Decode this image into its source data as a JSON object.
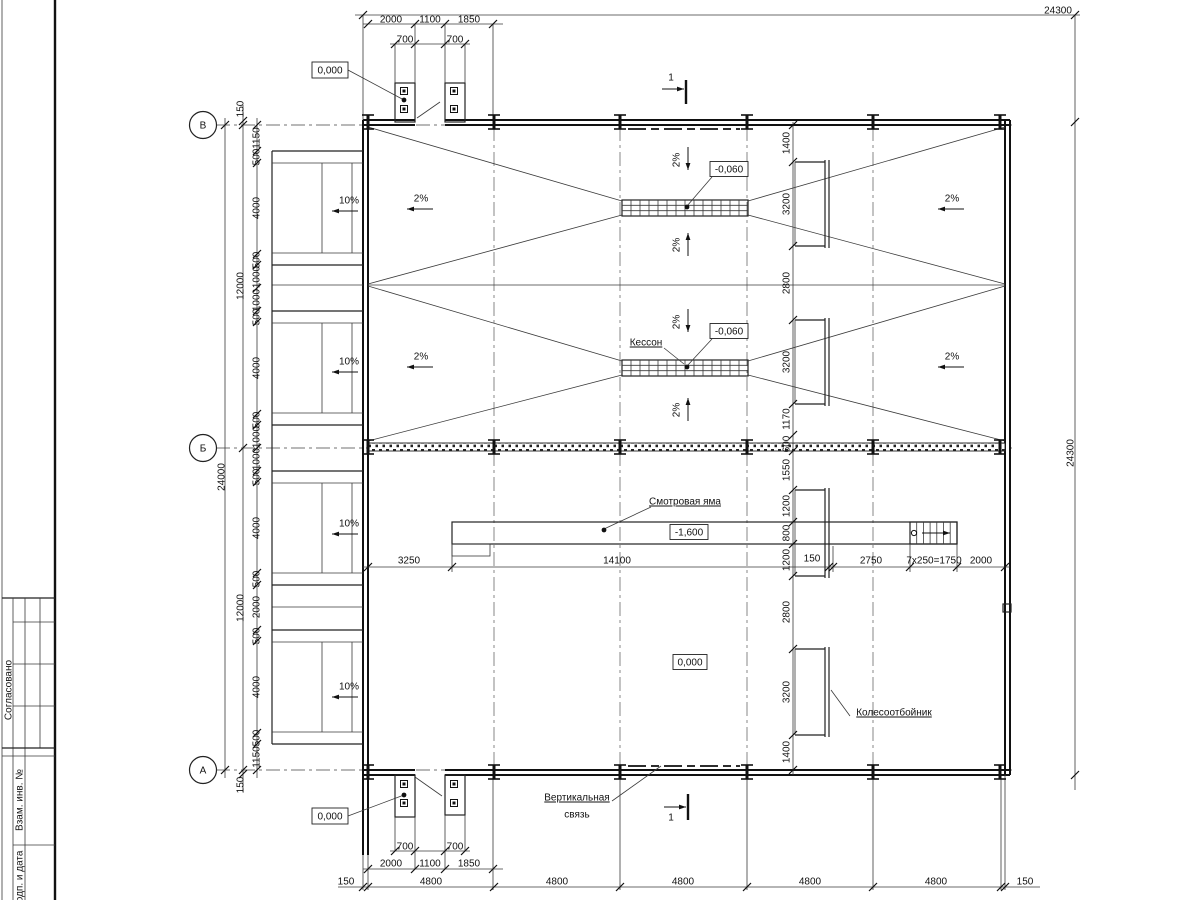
{
  "drawing": {
    "kind": "garage floor plan (Russian working drawing)",
    "axes": [
      "В",
      "Б",
      "А"
    ],
    "elevations": [
      "0,000",
      "-0,060",
      "-1,600"
    ],
    "section_mark": "1"
  },
  "stamp": {
    "col1": "Согласовано",
    "col2": "Взам. инв. №",
    "col3": "Подп. и дата"
  },
  "texts": [
    {
      "n": "dim-overall-top",
      "t": "24300",
      "x": 1058,
      "y": 10
    },
    {
      "n": "dim",
      "t": "2000",
      "x": 391,
      "y": 19
    },
    {
      "n": "dim",
      "t": "1100",
      "x": 430,
      "y": 19
    },
    {
      "n": "dim",
      "t": "1850",
      "x": 469,
      "y": 19
    },
    {
      "n": "dim",
      "t": "700",
      "x": 405,
      "y": 39
    },
    {
      "n": "dim",
      "t": "700",
      "x": 455,
      "y": 39
    },
    {
      "n": "elev",
      "t": "0,000",
      "x": 330,
      "y": 70,
      "b": 1,
      "bw": 36,
      "bh": 16
    },
    {
      "n": "section-number",
      "t": "1",
      "x": 671,
      "y": 77,
      "fs": 12
    },
    {
      "n": "dim",
      "t": "150",
      "x": 240,
      "y": 109,
      "r": 1
    },
    {
      "n": "dim",
      "t": "1150",
      "x": 256,
      "y": 138,
      "r": 1
    },
    {
      "n": "dim",
      "t": "500",
      "x": 256,
      "y": 157,
      "r": 1
    },
    {
      "n": "dim",
      "t": "4000",
      "x": 256,
      "y": 208,
      "r": 1
    },
    {
      "n": "dim",
      "t": "500",
      "x": 256,
      "y": 260,
      "r": 1
    },
    {
      "n": "dim",
      "t": "1000",
      "x": 256,
      "y": 277,
      "r": 1
    },
    {
      "n": "dim",
      "t": "1000",
      "x": 256,
      "y": 300,
      "r": 1
    },
    {
      "n": "dim",
      "t": "500",
      "x": 256,
      "y": 317,
      "r": 1
    },
    {
      "n": "dim",
      "t": "4000",
      "x": 256,
      "y": 368,
      "r": 1
    },
    {
      "n": "dim",
      "t": "500",
      "x": 256,
      "y": 420,
      "r": 1
    },
    {
      "n": "dim",
      "t": "1000",
      "x": 256,
      "y": 437,
      "r": 1
    },
    {
      "n": "dim",
      "t": "1000",
      "x": 256,
      "y": 459,
      "r": 1
    },
    {
      "n": "dim",
      "t": "500",
      "x": 256,
      "y": 477,
      "r": 1
    },
    {
      "n": "dim",
      "t": "4000",
      "x": 256,
      "y": 528,
      "r": 1
    },
    {
      "n": "dim",
      "t": "500",
      "x": 256,
      "y": 579,
      "r": 1
    },
    {
      "n": "dim",
      "t": "2000",
      "x": 256,
      "y": 607,
      "r": 1
    },
    {
      "n": "dim",
      "t": "500",
      "x": 256,
      "y": 636,
      "r": 1
    },
    {
      "n": "dim",
      "t": "4000",
      "x": 256,
      "y": 687,
      "r": 1
    },
    {
      "n": "dim",
      "t": "500",
      "x": 256,
      "y": 738,
      "r": 1
    },
    {
      "n": "dim",
      "t": "1150",
      "x": 256,
      "y": 757,
      "r": 1
    },
    {
      "n": "dim",
      "t": "12000",
      "x": 240,
      "y": 286,
      "r": 1
    },
    {
      "n": "dim",
      "t": "12000",
      "x": 240,
      "y": 608,
      "r": 1
    },
    {
      "n": "dim",
      "t": "24000",
      "x": 221,
      "y": 477,
      "r": 1
    },
    {
      "n": "dim",
      "t": "150",
      "x": 240,
      "y": 785,
      "r": 1
    },
    {
      "n": "axis",
      "t": "В",
      "x": 203,
      "y": 125,
      "fs": 13
    },
    {
      "n": "axis",
      "t": "Б",
      "x": 203,
      "y": 448,
      "fs": 13
    },
    {
      "n": "axis",
      "t": "А",
      "x": 203,
      "y": 770,
      "fs": 13
    },
    {
      "n": "slope",
      "t": "10%",
      "x": 349,
      "y": 200,
      "fs": 11
    },
    {
      "n": "slope",
      "t": "10%",
      "x": 349,
      "y": 361,
      "fs": 11
    },
    {
      "n": "slope",
      "t": "10%",
      "x": 349,
      "y": 523,
      "fs": 11
    },
    {
      "n": "slope",
      "t": "10%",
      "x": 349,
      "y": 686,
      "fs": 11
    },
    {
      "n": "slope",
      "t": "2%",
      "x": 421,
      "y": 198,
      "fs": 11
    },
    {
      "n": "slope",
      "t": "2%",
      "x": 421,
      "y": 356,
      "fs": 11
    },
    {
      "n": "slope",
      "t": "2%",
      "x": 952,
      "y": 198,
      "fs": 11
    },
    {
      "n": "slope",
      "t": "2%",
      "x": 952,
      "y": 356,
      "fs": 11
    },
    {
      "n": "slope",
      "t": "2%",
      "x": 676,
      "y": 160,
      "r": 1,
      "fs": 10
    },
    {
      "n": "slope",
      "t": "2%",
      "x": 676,
      "y": 245,
      "r": 1,
      "fs": 10
    },
    {
      "n": "slope",
      "t": "2%",
      "x": 676,
      "y": 322,
      "r": 1,
      "fs": 10
    },
    {
      "n": "slope",
      "t": "2%",
      "x": 676,
      "y": 410,
      "r": 1,
      "fs": 10
    },
    {
      "n": "elev",
      "t": "-0,060",
      "x": 729,
      "y": 169,
      "b": 1,
      "bw": 38,
      "bh": 15
    },
    {
      "n": "elev",
      "t": "-0,060",
      "x": 729,
      "y": 331,
      "b": 1,
      "bw": 38,
      "bh": 15
    },
    {
      "n": "note",
      "t": "Кессон",
      "x": 646,
      "y": 342,
      "u": 1
    },
    {
      "n": "note",
      "t": "Смотровая яма",
      "x": 685,
      "y": 501,
      "u": 1
    },
    {
      "n": "elev",
      "t": "-1,600",
      "x": 689,
      "y": 532,
      "b": 1,
      "bw": 38,
      "bh": 15
    },
    {
      "n": "elev",
      "t": "0,000",
      "x": 690,
      "y": 662,
      "b": 1,
      "bw": 34,
      "bh": 15
    },
    {
      "n": "dim",
      "t": "3250",
      "x": 409,
      "y": 560
    },
    {
      "n": "dim",
      "t": "14100",
      "x": 617,
      "y": 560
    },
    {
      "n": "dim",
      "t": "150",
      "x": 812,
      "y": 558
    },
    {
      "n": "dim",
      "t": "2750",
      "x": 871,
      "y": 560
    },
    {
      "n": "dim",
      "t": "7x250=1750",
      "x": 934,
      "y": 560,
      "fs": 9
    },
    {
      "n": "dim",
      "t": "2000",
      "x": 981,
      "y": 560
    },
    {
      "n": "dim",
      "t": "1400",
      "x": 786,
      "y": 143,
      "r": 1
    },
    {
      "n": "dim",
      "t": "3200",
      "x": 786,
      "y": 204,
      "r": 1
    },
    {
      "n": "dim",
      "t": "2800",
      "x": 786,
      "y": 283,
      "r": 1
    },
    {
      "n": "dim",
      "t": "3200",
      "x": 786,
      "y": 362,
      "r": 1
    },
    {
      "n": "dim",
      "t": "1170",
      "x": 786,
      "y": 419,
      "r": 1
    },
    {
      "n": "dim",
      "t": "600",
      "x": 786,
      "y": 444,
      "r": 1,
      "fs": 8
    },
    {
      "n": "dim",
      "t": "1550",
      "x": 786,
      "y": 470,
      "r": 1
    },
    {
      "n": "dim",
      "t": "1200",
      "x": 786,
      "y": 506,
      "r": 1
    },
    {
      "n": "dim",
      "t": "800",
      "x": 786,
      "y": 533,
      "r": 1
    },
    {
      "n": "dim",
      "t": "1200",
      "x": 786,
      "y": 560,
      "r": 1
    },
    {
      "n": "dim",
      "t": "2800",
      "x": 786,
      "y": 612,
      "r": 1
    },
    {
      "n": "dim",
      "t": "3200",
      "x": 786,
      "y": 692,
      "r": 1
    },
    {
      "n": "dim",
      "t": "1400",
      "x": 786,
      "y": 752,
      "r": 1
    },
    {
      "n": "dim-overall-right",
      "t": "24300",
      "x": 1070,
      "y": 453,
      "r": 1
    },
    {
      "n": "note",
      "t": "Колесоотбойник",
      "x": 894,
      "y": 712,
      "u": 1
    },
    {
      "n": "note",
      "t": "Вертикальная",
      "x": 577,
      "y": 797,
      "u": 1
    },
    {
      "n": "note",
      "t": "связь",
      "x": 577,
      "y": 814
    },
    {
      "n": "section-number",
      "t": "1",
      "x": 671,
      "y": 817,
      "fs": 12
    },
    {
      "n": "elev",
      "t": "0,000",
      "x": 330,
      "y": 816,
      "b": 1,
      "bw": 36,
      "bh": 16
    },
    {
      "n": "dim",
      "t": "700",
      "x": 405,
      "y": 846
    },
    {
      "n": "dim",
      "t": "700",
      "x": 455,
      "y": 846
    },
    {
      "n": "dim",
      "t": "2000",
      "x": 391,
      "y": 863
    },
    {
      "n": "dim",
      "t": "1100",
      "x": 430,
      "y": 863
    },
    {
      "n": "dim",
      "t": "1850",
      "x": 469,
      "y": 863
    },
    {
      "n": "dim",
      "t": "150",
      "x": 346,
      "y": 881
    },
    {
      "n": "dim",
      "t": "4800",
      "x": 431,
      "y": 881
    },
    {
      "n": "dim",
      "t": "4800",
      "x": 557,
      "y": 881
    },
    {
      "n": "dim",
      "t": "4800",
      "x": 683,
      "y": 881
    },
    {
      "n": "dim",
      "t": "4800",
      "x": 810,
      "y": 881
    },
    {
      "n": "dim",
      "t": "4800",
      "x": 936,
      "y": 881
    },
    {
      "n": "dim",
      "t": "150",
      "x": 1025,
      "y": 881
    },
    {
      "n": "stamp-label",
      "t": "Согласовано",
      "x": 8,
      "y": 690,
      "r": 1,
      "fs": 9
    },
    {
      "n": "stamp-label",
      "t": "Взам. инв. №",
      "x": 19,
      "y": 800,
      "r": 1,
      "fs": 9
    },
    {
      "n": "stamp-label",
      "t": "Подп. и дата",
      "x": 19,
      "y": 880,
      "r": 1,
      "fs": 9
    }
  ]
}
